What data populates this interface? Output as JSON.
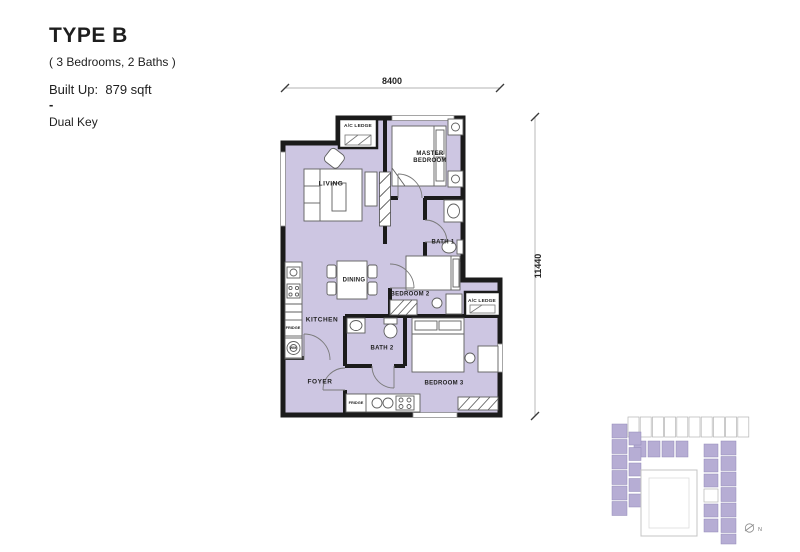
{
  "header": {
    "title": "TYPE B",
    "subtitle": "( 3 Bedrooms, 2 Baths )",
    "built_up": "Built Up:  879 sqft",
    "separator": "-",
    "key_type": "Dual Key"
  },
  "plan": {
    "dim_width": "8400",
    "dim_height": "11440",
    "labels": {
      "ac_ledge_top": "A/C LEDGE",
      "living": "LIVING",
      "master_bedroom": "MASTER BEDROOM",
      "bath_1": "BATH 1",
      "dining": "DINING",
      "bedroom_2": "BEDROOM 2",
      "ac_ledge_right": "A/C LEDGE",
      "kitchen": "KITCHEN",
      "bath_2": "BATH 2",
      "foyer": "FOYER",
      "bedroom_3": "BEDROOM 3",
      "fridge_kitchen": "FRIDGE",
      "washer": "WM",
      "fridge_suite": "FRIDGE"
    }
  },
  "key_plan": {
    "north": "N"
  },
  "colors": {
    "unit_fill": "#cdc6e2",
    "wall": "#1b1b1b",
    "keyplan_unit_fill": "#b6add4"
  }
}
